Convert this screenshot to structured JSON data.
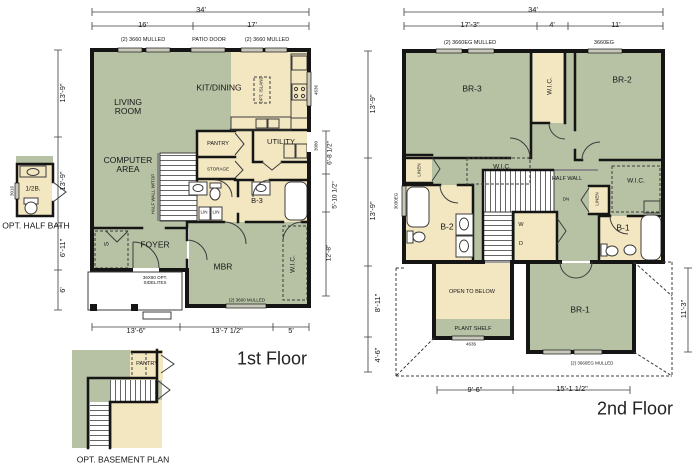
{
  "palette": {
    "room-green": "#b7c2a5",
    "room-cream": "#f3e7c2",
    "wall": "#151515",
    "line": "#3c3c3c",
    "window": "#c9c9bb"
  },
  "first_floor": {
    "caption": "1st Floor",
    "dims": {
      "total_width": "34'",
      "top_left": "16'",
      "top_right": "17'",
      "left_1": "13'-9\"",
      "left_2": "13'-9\"",
      "left_3": "6'-11\"",
      "left_4": "6'",
      "right_1": "6'-8 1/2\"",
      "right_2": "5'-10 1/2\"",
      "right_3": "12'-8\"",
      "bottom_1": "13'-6\"",
      "bottom_2": "13'-7 1/2\"",
      "bottom_3": "5'"
    },
    "openings": {
      "win_top_left": "(2) 3660 MULLED",
      "patio_door": "PATIO DOOR",
      "win_top_right": "(2) 3660 MULLED",
      "win_kitchen": "4636",
      "door_utility": "3080",
      "win_mbr": "(2) 3660 MULLED",
      "front_door": "36X80 OPT. SIDELITES"
    },
    "rooms": {
      "living": "LIVING ROOM",
      "kitchen": "KIT/DINING",
      "island": "OPT. ISLAND",
      "computer": "COMPUTER AREA",
      "pantry": "PANTRY",
      "utility": "UTILITY",
      "storage": "STORAGE",
      "bath": "B-3",
      "half_wall": "HALF WALL W/TOP",
      "lin1": "LIN",
      "lin2": "LIN",
      "closet": "S",
      "foyer": "FOYER",
      "mbr": "MBR",
      "wic": "W.I.C."
    }
  },
  "second_floor": {
    "caption": "2nd Floor",
    "dims": {
      "total_width": "34'",
      "top_left": "17'-3\"",
      "top_mid": "4'",
      "top_right": "11'",
      "left_1": "13'-9\"",
      "left_2": "13'-9\"",
      "left_3": "8'-11\"",
      "left_4": "4'-6\"",
      "right_1": "11'-3\"",
      "bottom_1": "9'-6\"",
      "bottom_2": "15'-1 1/2\""
    },
    "openings": {
      "win_br3": "(2) 3660EG MULLED",
      "win_br2": "3660EG",
      "win_left": "3030EG",
      "win_br1": "(2) 3660EG MULLED",
      "win_plant": "4636"
    },
    "rooms": {
      "br3": "BR-3",
      "wic_center": "W.I.C.",
      "br2": "BR-2",
      "linen_left": "LINEN",
      "wic_left": "W.I.C.",
      "half_wall": "HALF WALL",
      "dn": "DN",
      "linen_right": "LINEN",
      "wic_right": "W.I.C.",
      "b2": "B-2",
      "washer": "W",
      "dryer": "D",
      "b1": "B-1",
      "open_below": "OPEN TO BELOW",
      "plant_shelf": "PLANT SHELF",
      "br1": "BR-1"
    }
  },
  "opt_half_bath": {
    "caption": "OPT. HALF BATH",
    "label": "1/2B.",
    "window": "3016"
  },
  "opt_basement": {
    "caption": "OPT. BASEMENT PLAN",
    "pantry": "PANTRY"
  }
}
